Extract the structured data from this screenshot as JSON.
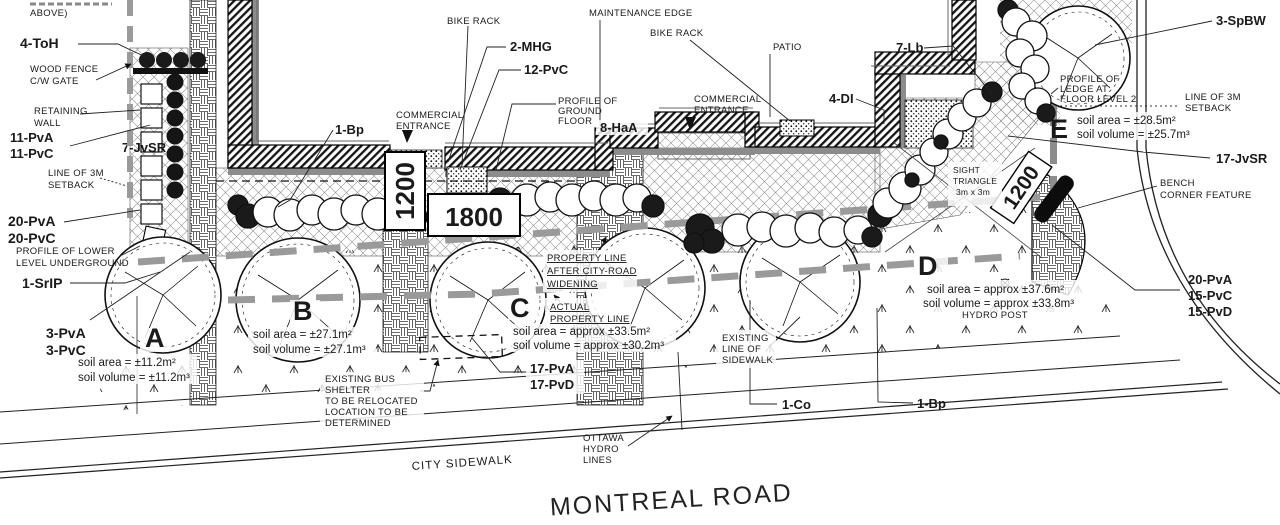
{
  "road": {
    "name": "MONTREAL ROAD",
    "sidewalk": "CITY SIDEWALK"
  },
  "dimensions": {
    "left_box": "1200",
    "center_box": "1800",
    "right_box": "1200"
  },
  "zones": {
    "a": {
      "letter": "A",
      "area": "soil area = ±11.2m²",
      "volume": "soil volume = ±11.2m³"
    },
    "b": {
      "letter": "B",
      "area": "soil area = ±27.1m²",
      "volume": "soil volume = ±27.1m³"
    },
    "c": {
      "letter": "C",
      "area": "soil area = approx ±33.5m²",
      "volume": "soil volume = approx ±30.2m³"
    },
    "d": {
      "letter": "D",
      "area": "soil area = approx ±37.6m²",
      "volume": "soil volume = approx ±33.8m³"
    },
    "e": {
      "letter": "E",
      "area": "soil area = ±28.5m²",
      "volume": "soil volume = ±25.7m³"
    }
  },
  "plants": {
    "toh4": "4-ToH",
    "pva11": "11-PvA",
    "pvc11": "11-PvC",
    "jvsr7": "7-JvSR",
    "pva20": "20-PvA",
    "pvc20": "20-PvC",
    "srip1": "1-SrIP",
    "pva3": "3-PvA",
    "pvc3": "3-PvC",
    "bp1_top": "1-Bp",
    "jvsr4": "4-JvSR",
    "mhg2": "2-MHG",
    "pvc12": "12-PvC",
    "haa8": "8-HaA",
    "di4": "4-DI",
    "lb7": "7-Lb",
    "spbw3": "3-SpBW",
    "jvsr17": "17-JvSR",
    "pva20r": "20-PvA",
    "pvc15": "15-PvC",
    "pvd15": "15-PvD",
    "pva17": "17-PvA",
    "pvd17": "17-PvD",
    "co1": "1-Co",
    "bp1_bottom": "1-Bp"
  },
  "labels": {
    "above_partial": "ABOVE)",
    "wood_fence_1": "WOOD FENCE",
    "wood_fence_2": "C/W GATE",
    "retaining_1": "RETAINING",
    "retaining_2": "WALL",
    "setback_left_1": "LINE OF 3M",
    "setback_left_2": "SETBACK",
    "profile_lower_1": "PROFILE OF LOWER",
    "profile_lower_2": "LEVEL UNDERGROUND",
    "bike_rack_1": "BIKE RACK",
    "bike_rack_2": "BIKE RACK",
    "maintenance_edge": "MAINTENANCE EDGE",
    "comm_ent_left_1": "COMMERCIAL",
    "comm_ent_left_2": "ENTRANCE",
    "comm_ent_right_1": "COMMERCIAL",
    "comm_ent_right_2": "ENTRANCE",
    "profile_ground_1": "PROFILE OF",
    "profile_ground_2": "GROUND",
    "profile_ground_3": "FLOOR",
    "patio": "PATIO",
    "profile_ledge_1": "PROFILE OF",
    "profile_ledge_2": "LEDGE AT",
    "profile_ledge_3": "FLOOR LEVEL 2",
    "setback_right_1": "LINE OF 3M",
    "setback_right_2": "SETBACK",
    "bench_1": "BENCH",
    "bench_2": "CORNER FEATURE",
    "sight_1": "SIGHT",
    "sight_2": "TRIANGLE",
    "sight_3": "3m x 3m",
    "hydro_post": "HYDRO POST",
    "prop_widen_1": "PROPERTY LINE",
    "prop_widen_2": "AFTER CITY-ROAD",
    "prop_widen_3": "WIDENING",
    "actual_prop_1": "ACTUAL",
    "actual_prop_2": "PROPERTY LINE",
    "bus_1": "EXISTING BUS",
    "bus_2": "SHELTER",
    "bus_3": "TO BE RELOCATED",
    "bus_4": "LOCATION TO BE",
    "bus_5": "DETERMINED",
    "exist_side_1": "EXISTING",
    "exist_side_2": "LINE OF",
    "exist_side_3": "SIDEWALK",
    "ottawa_1": "OTTAWA",
    "ottawa_2": "HYDRO",
    "ottawa_3": "LINES"
  }
}
